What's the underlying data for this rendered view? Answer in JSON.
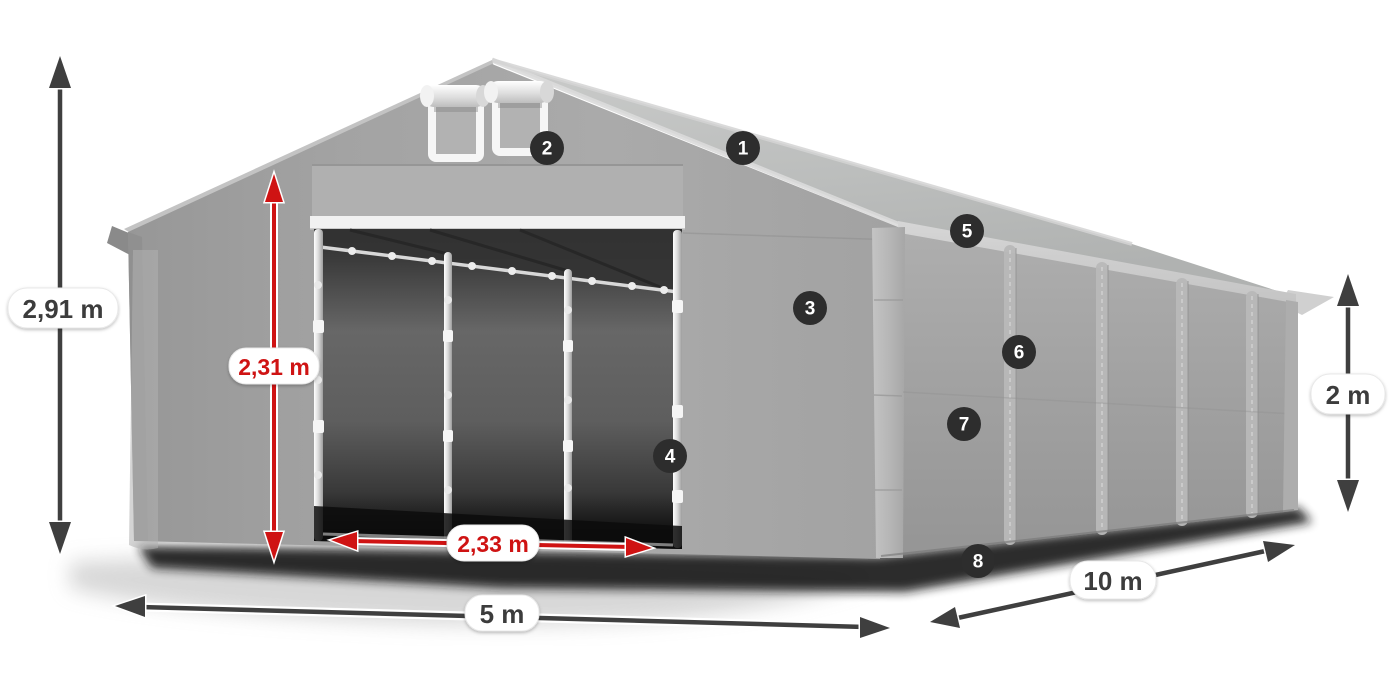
{
  "colors": {
    "accent_red": "#cf1313",
    "dim_dark": "#3f3f3f",
    "badge_bg": "#2d2d2d",
    "badge_text": "#ffffff",
    "pill_bg": "#ffffff",
    "pill_text_dark": "#3c3c3c",
    "pill_text_red": "#cf1313",
    "page_bg": "#ffffff"
  },
  "diagram": {
    "dimensions": [
      {
        "id": "total-height",
        "value": "2,91 m"
      },
      {
        "id": "door-height",
        "value": "2,31 m"
      },
      {
        "id": "door-width",
        "value": "2,33 m"
      },
      {
        "id": "tent-width",
        "value": "5 m"
      },
      {
        "id": "tent-length",
        "value": "10 m"
      },
      {
        "id": "side-height",
        "value": "2 m"
      }
    ],
    "hotspots": [
      {
        "number": "1"
      },
      {
        "number": "2"
      },
      {
        "number": "3"
      },
      {
        "number": "4"
      },
      {
        "number": "5"
      },
      {
        "number": "6"
      },
      {
        "number": "7"
      },
      {
        "number": "8"
      }
    ]
  }
}
